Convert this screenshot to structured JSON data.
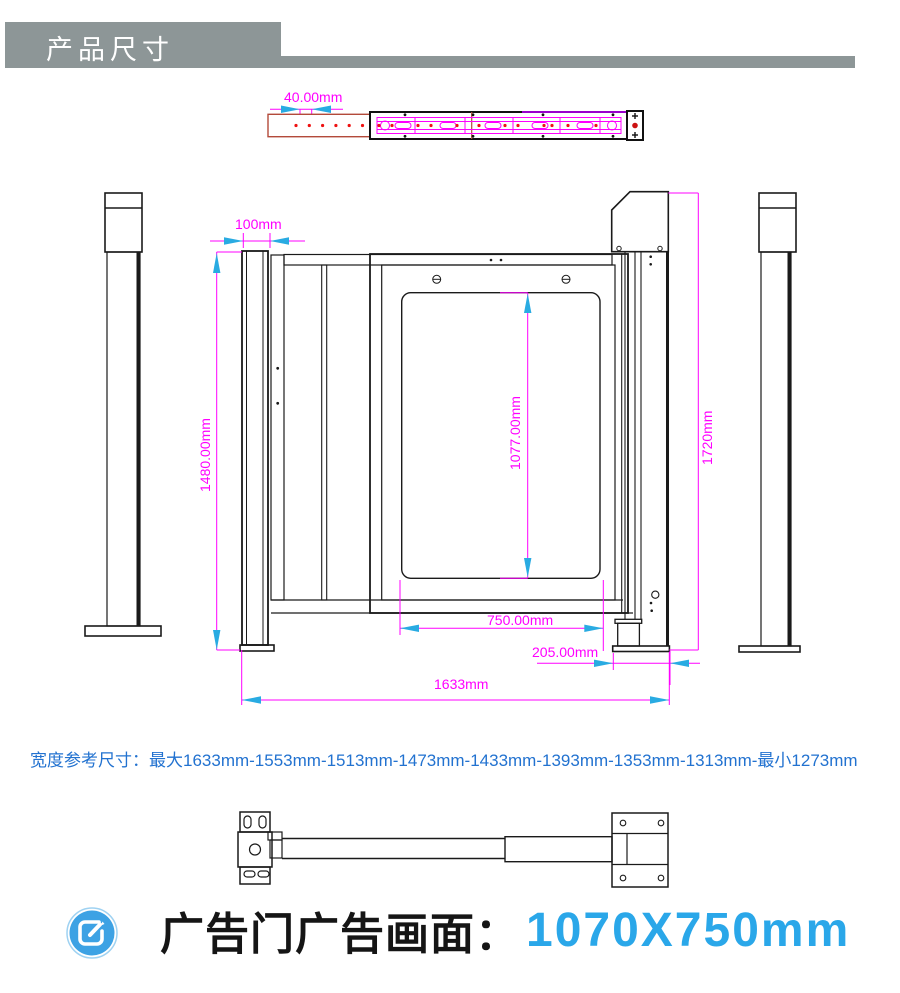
{
  "header": {
    "title": "产品尺寸"
  },
  "dimensions": {
    "top_view_pitch": "40.00mm",
    "post_width": "100mm",
    "door_height": "1480.00mm",
    "ad_window_height": "1077.00mm",
    "machine_height": "1720mm",
    "ad_window_width": "750.00mm",
    "base_width": "205.00mm",
    "overall_width": "1633mm"
  },
  "width_reference": {
    "label": "宽度参考尺寸：",
    "value": "最大1633mm-1553mm-1513mm-1473mm-1433mm-1393mm-1353mm-1313mm-最小1273mm"
  },
  "footer": {
    "label": "广告门广告画面：",
    "value": "1070X750mm"
  },
  "colors": {
    "header_bg": "#8d9697",
    "dimension_line": "#ff00ff",
    "arrow_blue": "#29abe2",
    "reference_text": "#2272d0",
    "footer_value": "#2aa7e9",
    "beam_outline_red": "#b34a3a"
  }
}
